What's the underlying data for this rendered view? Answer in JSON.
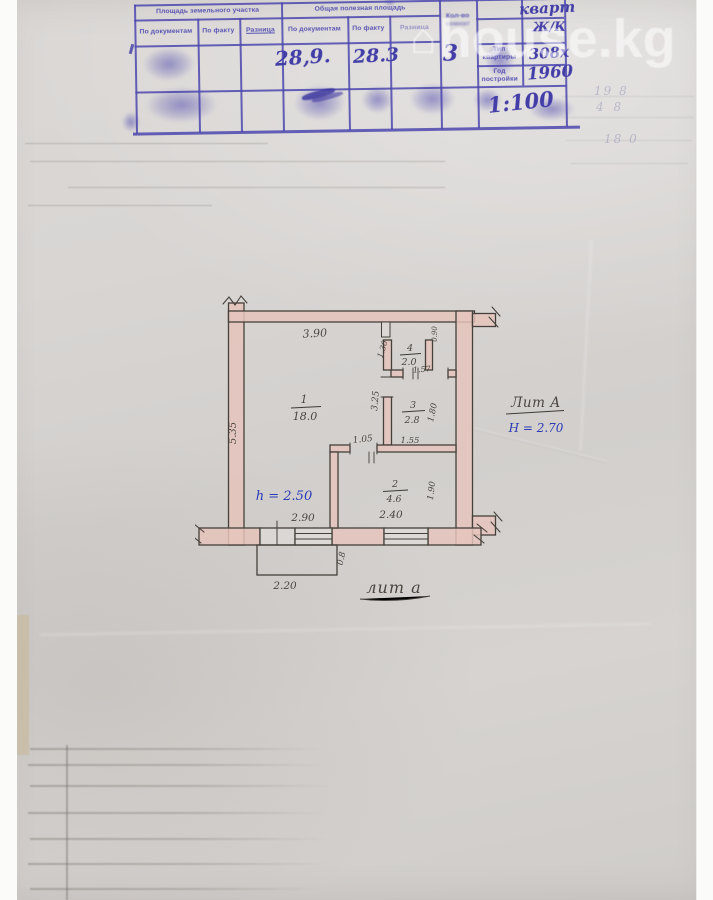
{
  "watermark": {
    "text": "house.kg"
  },
  "stamp": {
    "land_area_header": "Площадь земельного участка",
    "useful_area_header": "Общая полезная площадь",
    "sub_docs": "По документам",
    "sub_fact": "По факту",
    "sub_diff": "Разница",
    "count_header_1": "Кол-во",
    "count_header_2": "комнат",
    "area_by_docs": "28,9.",
    "area_by_fact": "28.3",
    "count_value": "3",
    "apt_note": "кварт",
    "zhk_note": "Ж/К",
    "type_label": "Тип квартиры",
    "type_value": "308х",
    "year_label": "Год постройки",
    "year_value": "1960",
    "scale": "1:100"
  },
  "ghost_notes": {
    "n1": "19 8",
    "n2": "4 8",
    "n3": "18 0"
  },
  "plan": {
    "dim_top": "3.90",
    "dim_left": "5.35",
    "r1_num": "1",
    "r1_area": "18.0",
    "r2_num": "2",
    "r2_area": "4.6",
    "r3_num": "3",
    "r3_area": "2.8",
    "r4_num": "4",
    "r4_area": "2.0",
    "r4_dim_h": "1.30",
    "r4_door": "1.57",
    "niche_dim": "0.90",
    "hall_dim": "3.25",
    "r3_dim_w": "1.55",
    "r3_dim_h": "1.80",
    "r2_door": "1.05",
    "r2_dim_h": "1.90",
    "dim_win1": "2.90",
    "dim_win2": "2.40",
    "porch_w": "2.20",
    "porch_d": "0.8",
    "h_note": "h = 2.50",
    "lit_main": "Лит А",
    "lit_h": "Н = 2.70",
    "lit_porch": "лит а"
  }
}
